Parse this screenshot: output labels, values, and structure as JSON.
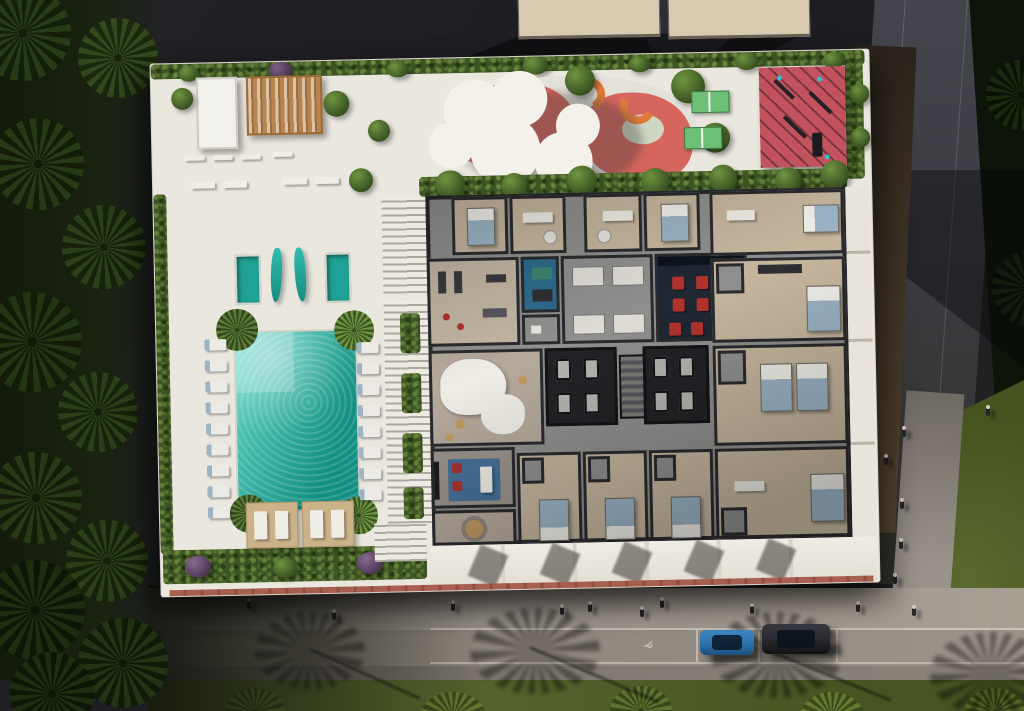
{
  "scene": {
    "description": "Aerial dusk rendering of a residential building: rooftop amenity deck with pool, plunge pools, lounge chairs, cabanas, playground with cloud canopy, ping-pong tables and red fitness court, plus a cutaway apartment floor plan; street below with sidewalk, pedestrians, two parked cars and palm shadows",
    "icons": {
      "accessible_parking": "♿"
    },
    "colors": {
      "asphalt": "#1f1f23",
      "asphalt_light": "#31313a",
      "road_gray": "#3b3b42",
      "deck_white": "#eae7df",
      "pool_teal": "#23ada0",
      "pool_light": "#66d8c9",
      "plunge_teal": "#1fa295",
      "hedge_green": "#3c5424",
      "tree_green": "#4c6b2c",
      "palm_dark": "#22340f",
      "playground_coral": "#d5655d",
      "slide_orange": "#df7a3a",
      "playground_teal": "#4a8a67",
      "pingpong_green": "#6fc077",
      "court_red": "#c2525e",
      "pergola_wood": "#b9854e",
      "canopy_white": "#f3f1ea",
      "wall_dark": "#2b2b2f",
      "floor_beige": "#c6b69e",
      "corridor_gray": "#8f8f8d",
      "cinema_navy": "#1f2733",
      "seat_red": "#b2332d",
      "spa_blue": "#2f6b8c",
      "rug_blue": "#47719b",
      "bed_blue": "#9cb4c6",
      "cabana_tan": "#ccb289",
      "terracotta": "#a95f4e",
      "sidewalk_gray": "#98918a",
      "sidewalk_light": "#a89f93",
      "grass_green": "#4f5d2c",
      "grass_light": "#6d8038",
      "roof_beige": "#d9cab2",
      "car_blue": "#2d72ae",
      "car_dark": "#26262b"
    },
    "counts": {
      "plunge_pools": 2,
      "shade_sails": 2,
      "pingpong_tables": 2,
      "cabanas": 2,
      "lounge_chairs_left": 9,
      "lounge_chairs_right": 8,
      "parked_cars": 2,
      "cinema_seats": 10,
      "street_pedestrians": 10,
      "side_pedestrians": 6
    }
  }
}
